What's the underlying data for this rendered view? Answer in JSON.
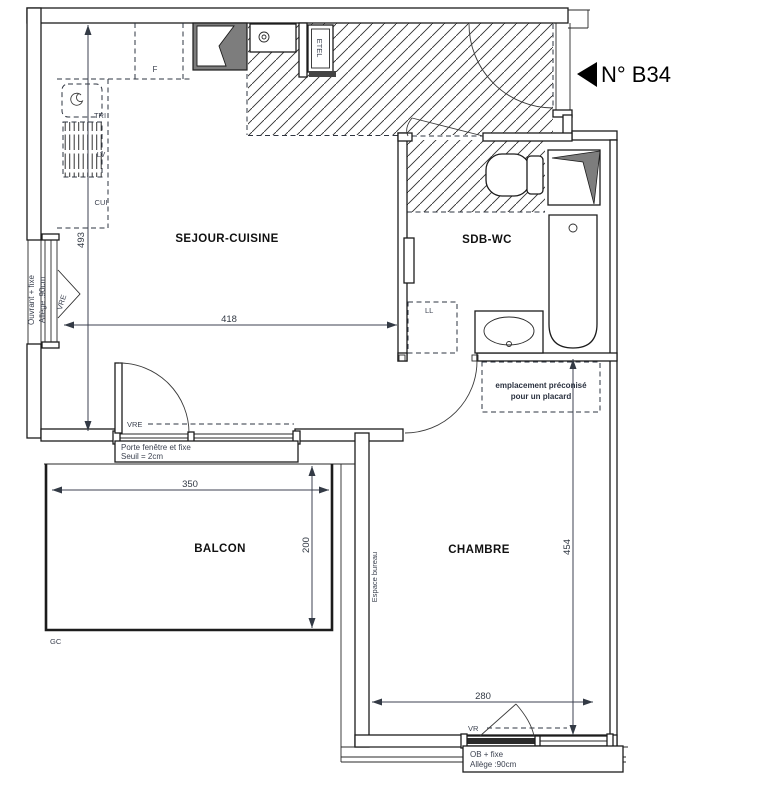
{
  "unit": {
    "number_label": "N° B34"
  },
  "rooms": {
    "sejour": "SEJOUR-CUISINE",
    "sdb": "SDB-WC",
    "balcon": "BALCON",
    "chambre": "CHAMBRE"
  },
  "dimensions": {
    "sejour_depth": "493",
    "sejour_width": "418",
    "balcon_width": "350",
    "balcon_depth": "200",
    "chambre_depth": "454",
    "chambre_width": "280"
  },
  "kitchen": {
    "fridge": "F",
    "tri": "TRI",
    "dishwasher": "LV",
    "cooker": "CUI",
    "electrical_panel": "ETEL"
  },
  "bathroom": {
    "washing_machine": "LL"
  },
  "openings": {
    "left_window_type": "Ouvrant + fixe",
    "left_window_sill": "Allège :90cm",
    "left_window_shutter": "VRE",
    "balcony_door_shutter": "VRE",
    "balcony_door_line1": "Porte fenêtre et fixe",
    "balcony_door_line2": "Seuil = 2cm",
    "bedroom_window_shutter": "VR",
    "bedroom_window_type": "OB + fixe",
    "bedroom_window_sill": "Allège :90cm"
  },
  "notes": {
    "placard_line1": "emplacement préconisé",
    "placard_line2": "pour un placard",
    "espace_bureau": "Espace bureau",
    "gc": "GC"
  },
  "colors": {
    "line": "#1c1c1c",
    "annotation": "#3c4250",
    "shaft_gray": "#7d7d7d"
  }
}
